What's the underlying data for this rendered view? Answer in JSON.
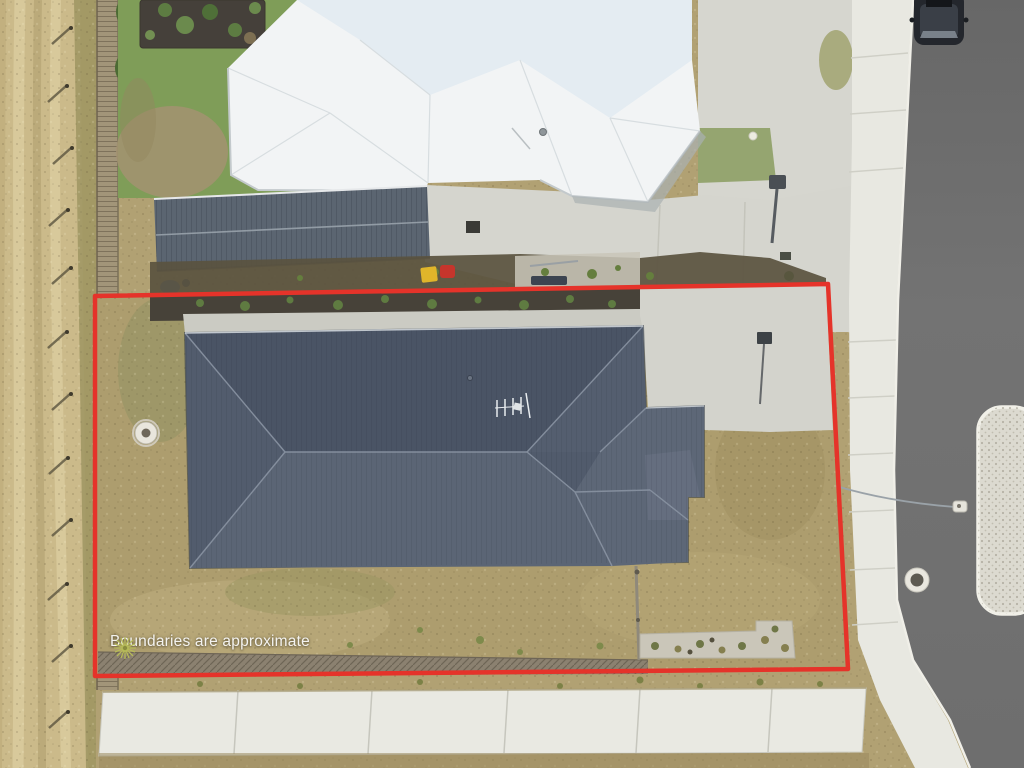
{
  "overlay": {
    "disclaimer_text": "Boundaries are approximate",
    "boundary_color": "#e5332a",
    "starburst_icon_color": "#b6ba58"
  }
}
